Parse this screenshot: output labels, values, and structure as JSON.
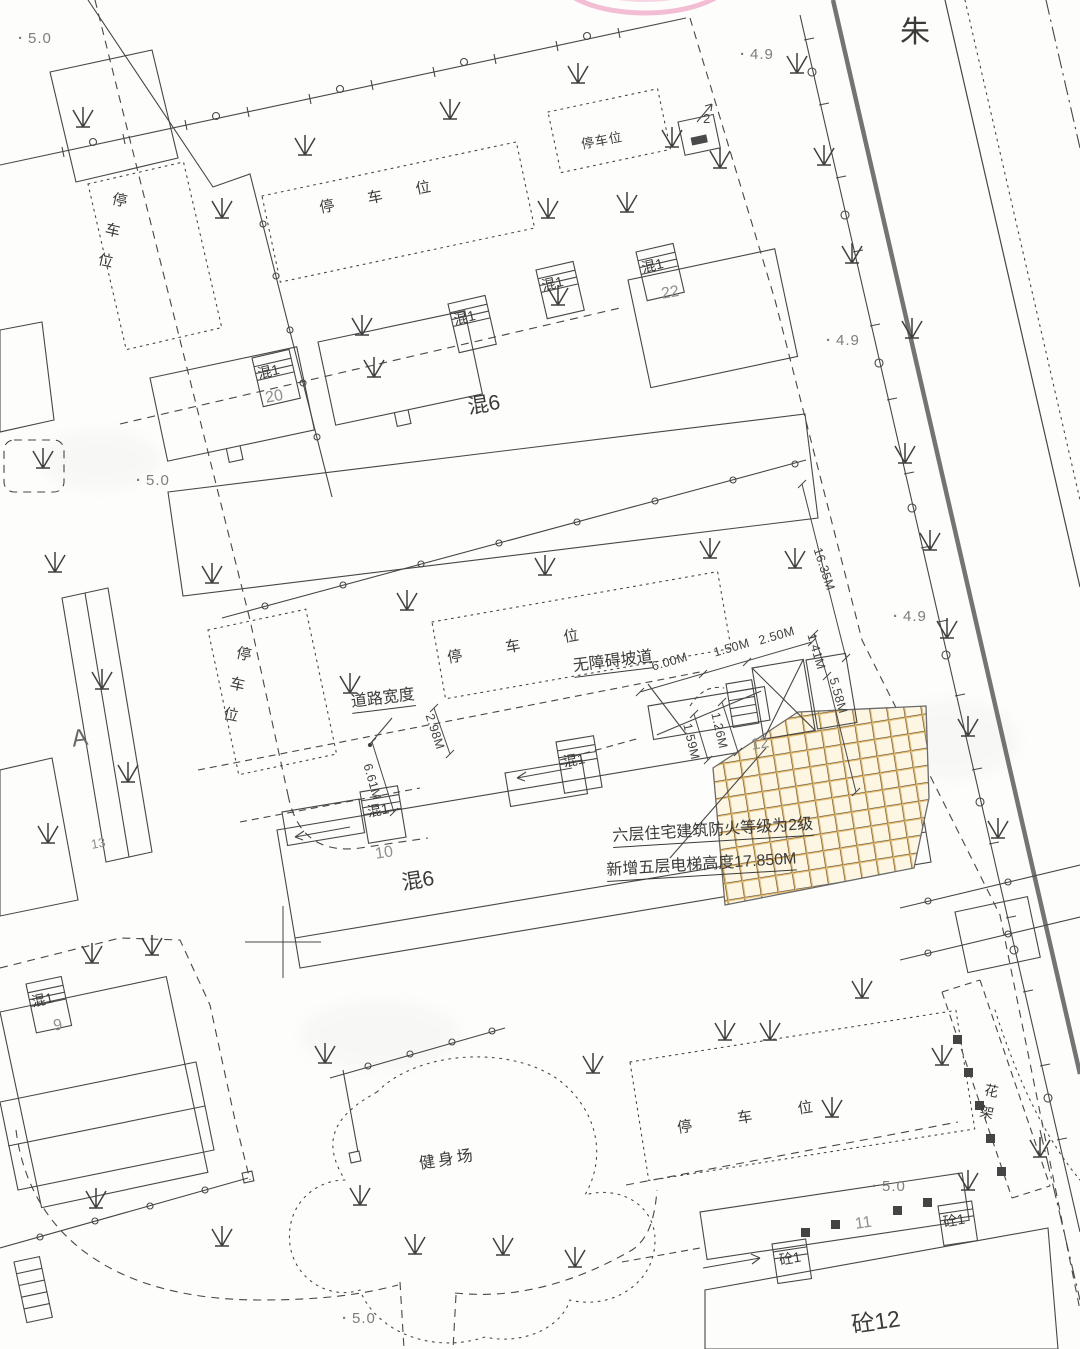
{
  "plan": {
    "street_label": "朱",
    "elevations": [
      "5.0",
      "4.9",
      "4.9",
      "5.0",
      "4.9",
      "5.0",
      "5.0"
    ],
    "building_labels": {
      "hun6": "混6",
      "hun1": "混1",
      "tong1": "砼1",
      "tong12": "砼12",
      "block_A": "A"
    },
    "building_numbers": [
      "20",
      "22",
      "10",
      "12",
      "9",
      "11",
      "13",
      "2"
    ],
    "area_labels": {
      "parking": "停车位",
      "fitness": "健身场",
      "trellis": "花架"
    },
    "annotations": {
      "road_width": "道路宽度",
      "accessible_ramp": "无障碍坡道",
      "note_line1": "六层住宅建筑防火等级为2级",
      "note_line2": "新增五层电梯高度17.850M"
    },
    "dimensions": [
      "6.00M",
      "1.50M",
      "2.50M",
      "1.41M",
      "5.58M",
      "1.59M",
      "1.26M",
      "2.98M",
      "6.61M",
      "16.35M"
    ],
    "colors": {
      "highlight_fill": "#fcf6e3",
      "highlight_grid": "#e5b55e",
      "marker_pink": "#f0aecb",
      "ink": "#3d3d3d"
    }
  }
}
